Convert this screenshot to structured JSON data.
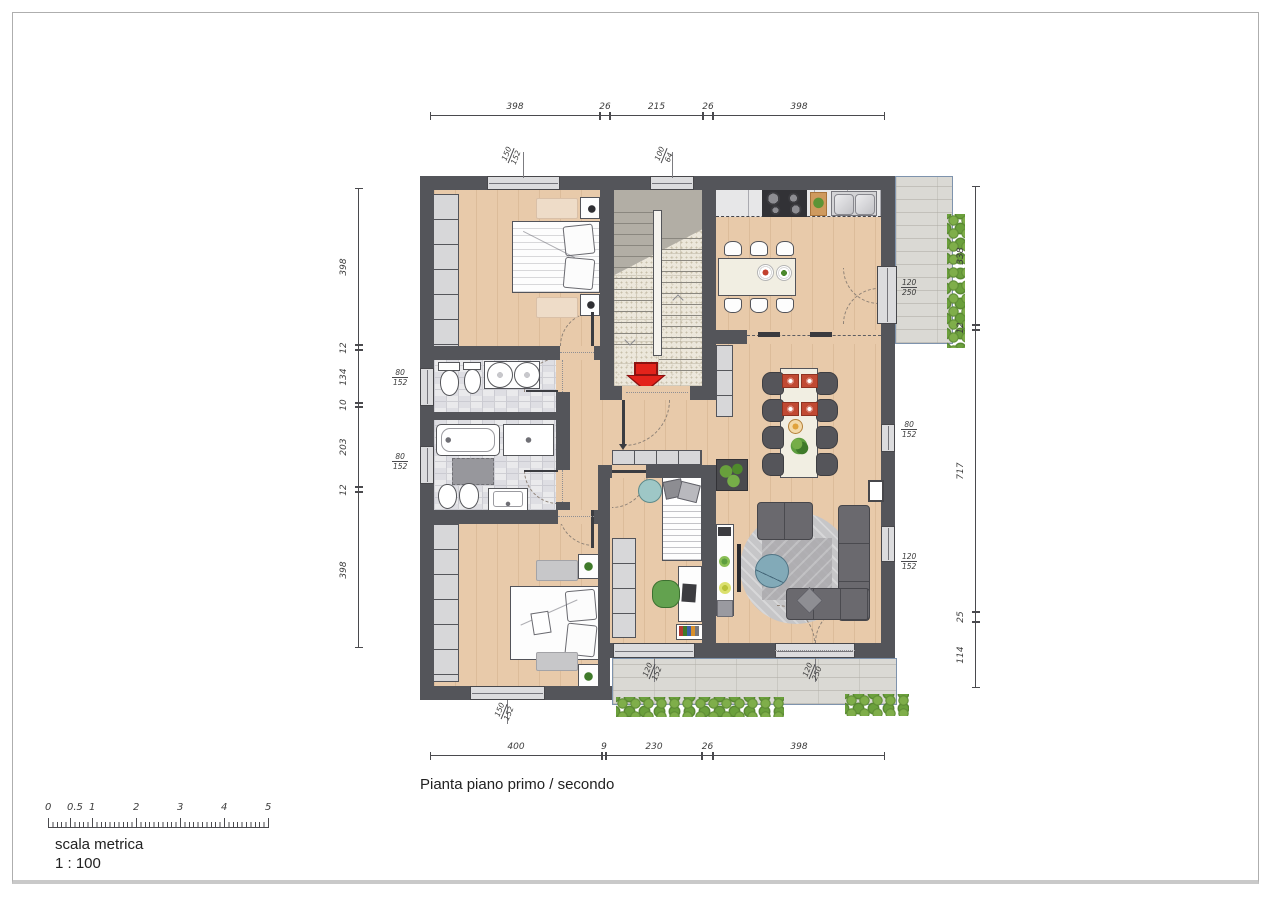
{
  "title": "Pianta piano primo / secondo",
  "scale_bar": {
    "label": "scala metrica",
    "ratio": "1 : 100",
    "ticks": [
      "0",
      "0.5",
      "1",
      "2",
      "3",
      "4",
      "5"
    ]
  },
  "dimensions": {
    "top": [
      "398",
      "26",
      "215",
      "26",
      "398"
    ],
    "bottom": [
      "400",
      "9",
      "230",
      "26",
      "398"
    ],
    "left": [
      "398",
      "12",
      "134",
      "10",
      "203",
      "12",
      "398"
    ],
    "right": [
      "338",
      "12",
      "717",
      "25",
      "114"
    ]
  },
  "windows": [
    {
      "id": "bedroom1-top-window",
      "w": "150",
      "h": "152"
    },
    {
      "id": "stairwell-top-window",
      "w": "100",
      "h": "64"
    },
    {
      "id": "kitchen-balcony-door",
      "w": "120",
      "h": "250"
    },
    {
      "id": "bathroom1-left-window",
      "w": "80",
      "h": "152"
    },
    {
      "id": "bathroom2-left-window",
      "w": "80",
      "h": "152"
    },
    {
      "id": "living-right-window-upper",
      "w": "80",
      "h": "152"
    },
    {
      "id": "living-right-window-lower",
      "w": "120",
      "h": "152"
    },
    {
      "id": "bedroom2-bottom-window",
      "w": "150",
      "h": "152"
    },
    {
      "id": "bedroom3-bottom-window",
      "w": "120",
      "h": "152"
    },
    {
      "id": "living-balcony-door",
      "w": "120",
      "h": "250"
    }
  ],
  "colors": {
    "wall": "#54555a",
    "wood_floor": "#e8caaa",
    "tile_floor": "#eaeaec",
    "stair_floor": "#ece7db",
    "terrace": "#dad9d4",
    "hedge_green": "#76a342",
    "entry_arrow_red": "#e3231b",
    "dim_text": "#3c3c3c"
  }
}
